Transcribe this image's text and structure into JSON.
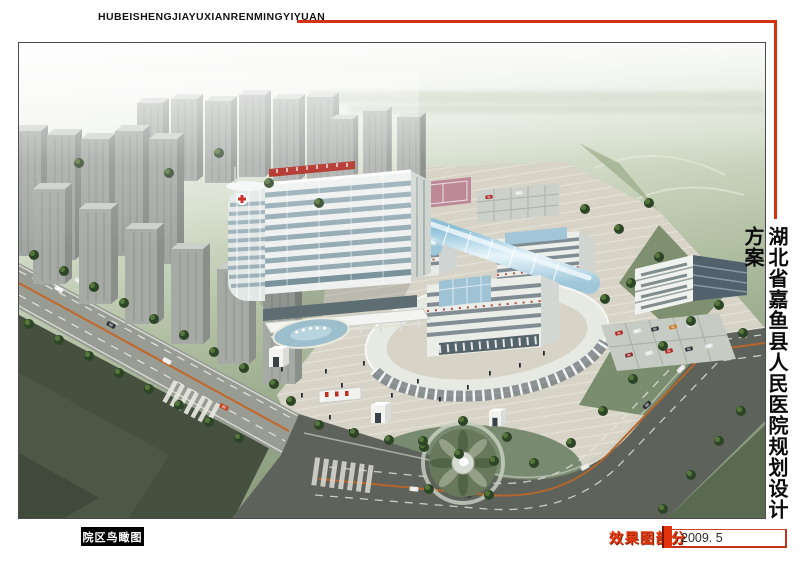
{
  "header": {
    "title_pinyin": "HUBEISHENGJIAYUXIANRENMINGYIYUAN"
  },
  "sidebar": {
    "title_vertical": "湖北省嘉鱼县人民医院规划设计方案"
  },
  "footer": {
    "view_label": "院区鸟瞰图",
    "section_label": "效果图部分",
    "date": "2009. 5"
  },
  "colors": {
    "accent": "#d5310e",
    "accent_dark": "#9c1e04",
    "label_bg": "#000000",
    "label_text": "#ffffff",
    "page_bg": "#ffffff",
    "ink": "#141414",
    "date_ink": "#2b2b2b"
  }
}
